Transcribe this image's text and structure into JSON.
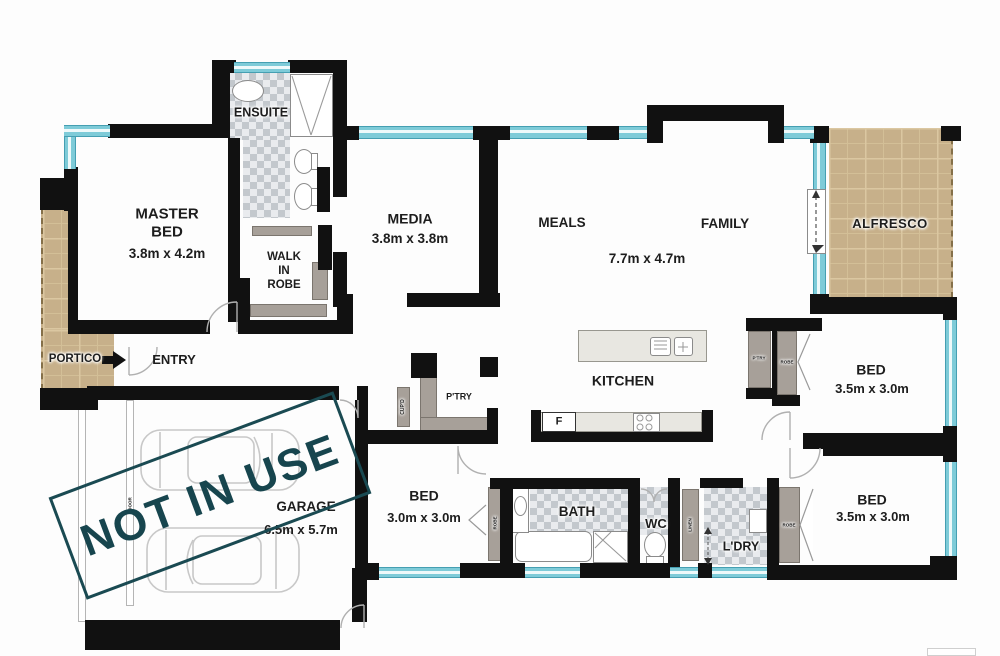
{
  "plan_title": "residential floor plan",
  "stamp": {
    "text": "NOT IN USE",
    "color": "#17454e"
  },
  "colors": {
    "wall": "#111111",
    "window_glass": "#7ecbd8",
    "paver_tan": "#c7b08a",
    "tile_dark": "#c3c8cd",
    "tile_light": "#e9ebee",
    "closet_gray": "#a7a099",
    "stamp_teal": "#17454e"
  },
  "labels": {
    "master_bed": "MASTER\nBED",
    "master_bed_dims": "3.8m x 4.2m",
    "ensuite": "ENSUITE",
    "walk_in_robe": "WALK\nIN\nROBE",
    "media": "MEDIA",
    "media_dims": "3.8m x 3.8m",
    "meals": "MEALS",
    "family": "FAMILY",
    "living_dims": "7.7m x 4.7m",
    "alfresco": "ALFRESCO",
    "portico": "PORTICO",
    "entry": "ENTRY",
    "kitchen": "KITCHEN",
    "pantry": "P'TRY",
    "cupboard": "CUP'D",
    "fridge": "F",
    "bed2": "BED",
    "bed2_dims": "3.5m x 3.0m",
    "bed2_pantry": "P'TRY",
    "bed2_robe": "ROBE",
    "bed3": "BED",
    "bed3_dims": "3.0m x 3.0m",
    "bed3_robe": "ROBE",
    "bath": "BATH",
    "wc": "WC",
    "linen": "LINEN",
    "laundry": "L'DRY",
    "bed4": "BED",
    "bed4_dims": "3.5m x 3.0m",
    "bed4_robe": "ROBE",
    "garage": "GARAGE",
    "garage_dims": "6.5m x 5.7m",
    "garage_door": "DOOR"
  }
}
